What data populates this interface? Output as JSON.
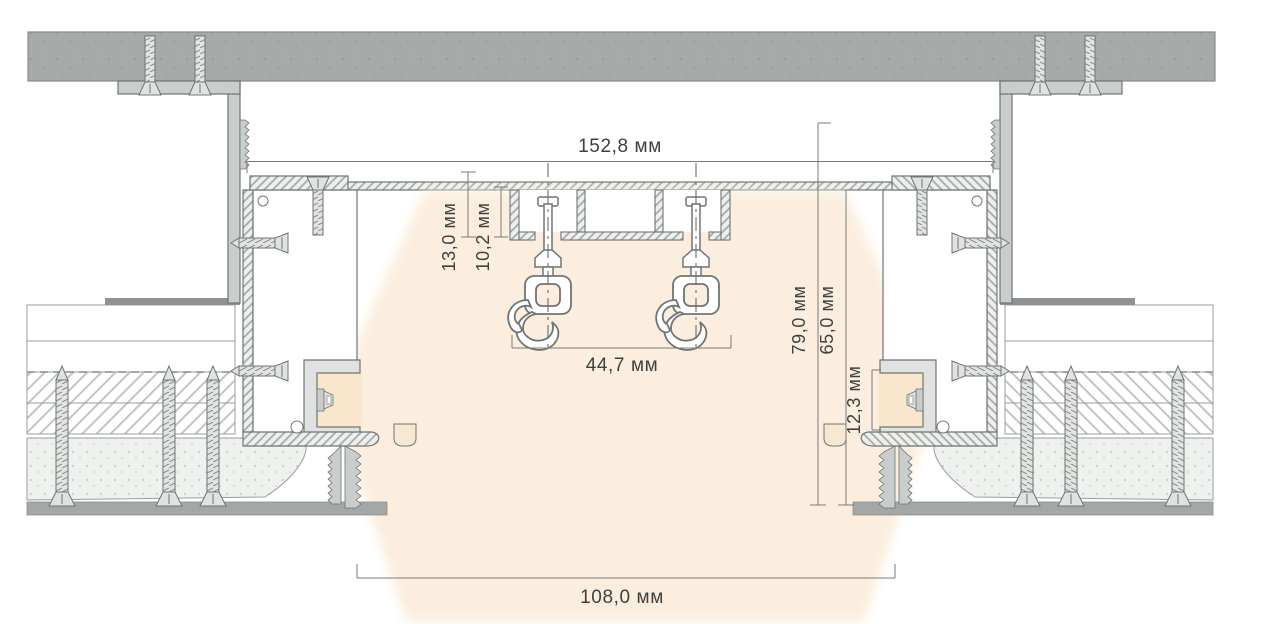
{
  "diagram": {
    "units": "мм",
    "dimensions": {
      "top_width": "152,8 мм",
      "track_height": "13,0 мм",
      "glider_channel_height": "10,2 мм",
      "hook_spacing": "44,7 мм",
      "niche_height_outer": "79,0 мм",
      "niche_height_inner": "65,0 мм",
      "led_module_height": "12,3 мм",
      "bottom_opening_width": "108,0 мм"
    },
    "colors": {
      "concrete": "#a7aaa8",
      "profile_gray": "#c9cdcb",
      "outline": "#6f7573",
      "glow": "#fbeedd",
      "glow_bright": "#f8e7cd",
      "dimension_text": "#3d4240",
      "background": "#ffffff"
    }
  }
}
